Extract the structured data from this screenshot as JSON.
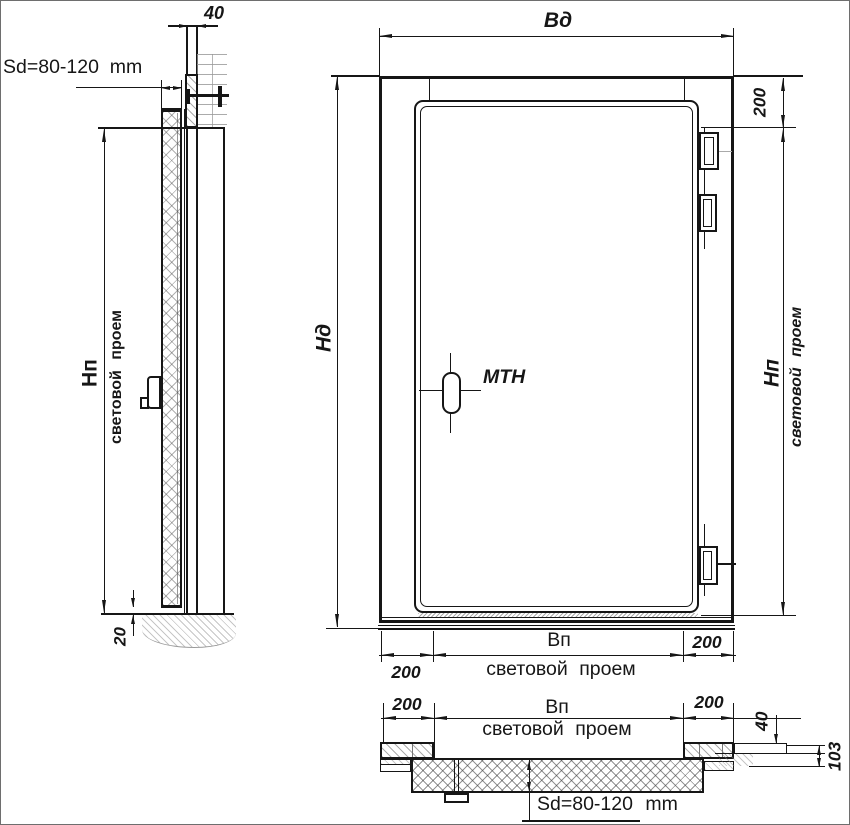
{
  "colors": {
    "line": "#161616",
    "hatch": "#8f8f8f"
  },
  "side_view": {
    "panel_thickness": "40",
    "door_thickness_range": "Sd=80-120  mm",
    "opening_height_label": "Нп",
    "opening_height_caption": "световой проем",
    "floor_gap": "20"
  },
  "front_view": {
    "door_width_label": "Вд",
    "door_height_label": "Нд",
    "frame_overlap_top": "200",
    "opening_height_label": "Нп",
    "opening_height_caption": "световой проем",
    "handle_label": "МТН",
    "frame_overlap_left": "200",
    "opening_width_label": "Вп",
    "opening_width_caption": "световой проем",
    "frame_overlap_right": "200"
  },
  "plan_view": {
    "frame_overlap_left": "200",
    "opening_width_label": "Вп",
    "opening_width_caption": "световой проем",
    "frame_overlap_right": "200",
    "panel_thickness": "40",
    "frame_depth": "103",
    "door_thickness_range": "Sd=80-120 mm"
  }
}
